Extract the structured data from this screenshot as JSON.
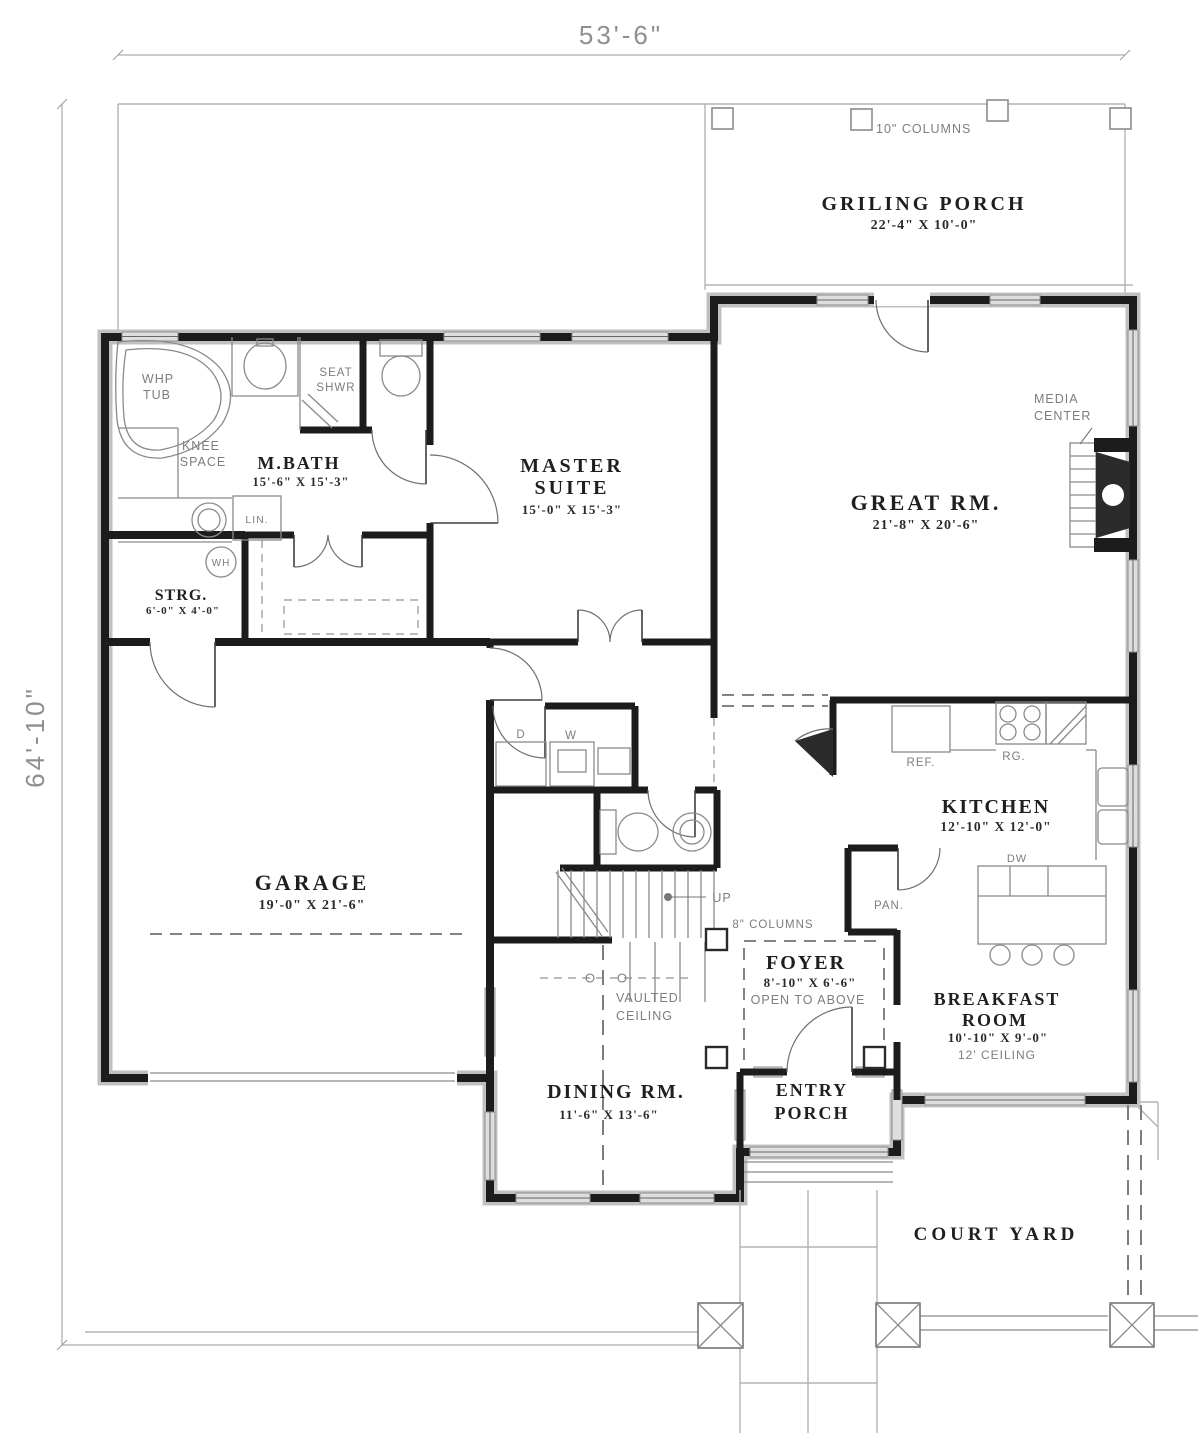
{
  "plan": {
    "overall_width": "53'-6\"",
    "overall_depth": "64'-10\"",
    "rooms": {
      "griling_porch": {
        "name": "GRILING PORCH",
        "size": "22'-4\" X 10'-0\""
      },
      "master_bath": {
        "name": "M.BATH",
        "size": "15'-6\" X 15'-3\""
      },
      "master_suite": {
        "line1": "MASTER",
        "line2": "SUITE",
        "size": "15'-0\" X 15'-3\""
      },
      "great_room": {
        "name": "GREAT RM.",
        "size": "21'-8\" X 20'-6\""
      },
      "storage": {
        "name": "STRG.",
        "size": "6'-0\" X 4'-0\""
      },
      "garage": {
        "name": "GARAGE",
        "size": "19'-0\" X 21'-6\""
      },
      "kitchen": {
        "name": "KITCHEN",
        "size": "12'-10\" X 12'-0\""
      },
      "foyer": {
        "name": "FOYER",
        "size": "8'-10\" X 6'-6\"",
        "note": "OPEN TO ABOVE"
      },
      "breakfast": {
        "line1": "BREAKFAST",
        "line2": "ROOM",
        "size": "10'-10\" X 9'-0\"",
        "note": "12' CEILING"
      },
      "dining": {
        "name": "DINING RM.",
        "size": "11'-6\" X 13'-6\""
      },
      "entry_porch": {
        "line1": "ENTRY",
        "line2": "PORCH"
      },
      "court_yard": {
        "name": "COURT YARD"
      }
    },
    "annotations": {
      "columns10": "10\" COLUMNS",
      "columns8": "8\" COLUMNS",
      "media_center": {
        "line1": "MEDIA",
        "line2": "CENTER"
      },
      "whp_tub": {
        "line1": "WHP",
        "line2": "TUB"
      },
      "knee_space": {
        "line1": "KNEE",
        "line2": "SPACE"
      },
      "seat_shwr": {
        "line1": "SEAT",
        "line2": "SHWR"
      },
      "vaulted_ceiling": {
        "line1": "VAULTED",
        "line2": "CEILING"
      },
      "linen": "LIN.",
      "water_heater": "WH",
      "dryer": "D",
      "washer": "W",
      "up": "UP",
      "refrigerator": "REF.",
      "range": "RG.",
      "dishwasher": "DW",
      "pantry": "PAN."
    }
  }
}
